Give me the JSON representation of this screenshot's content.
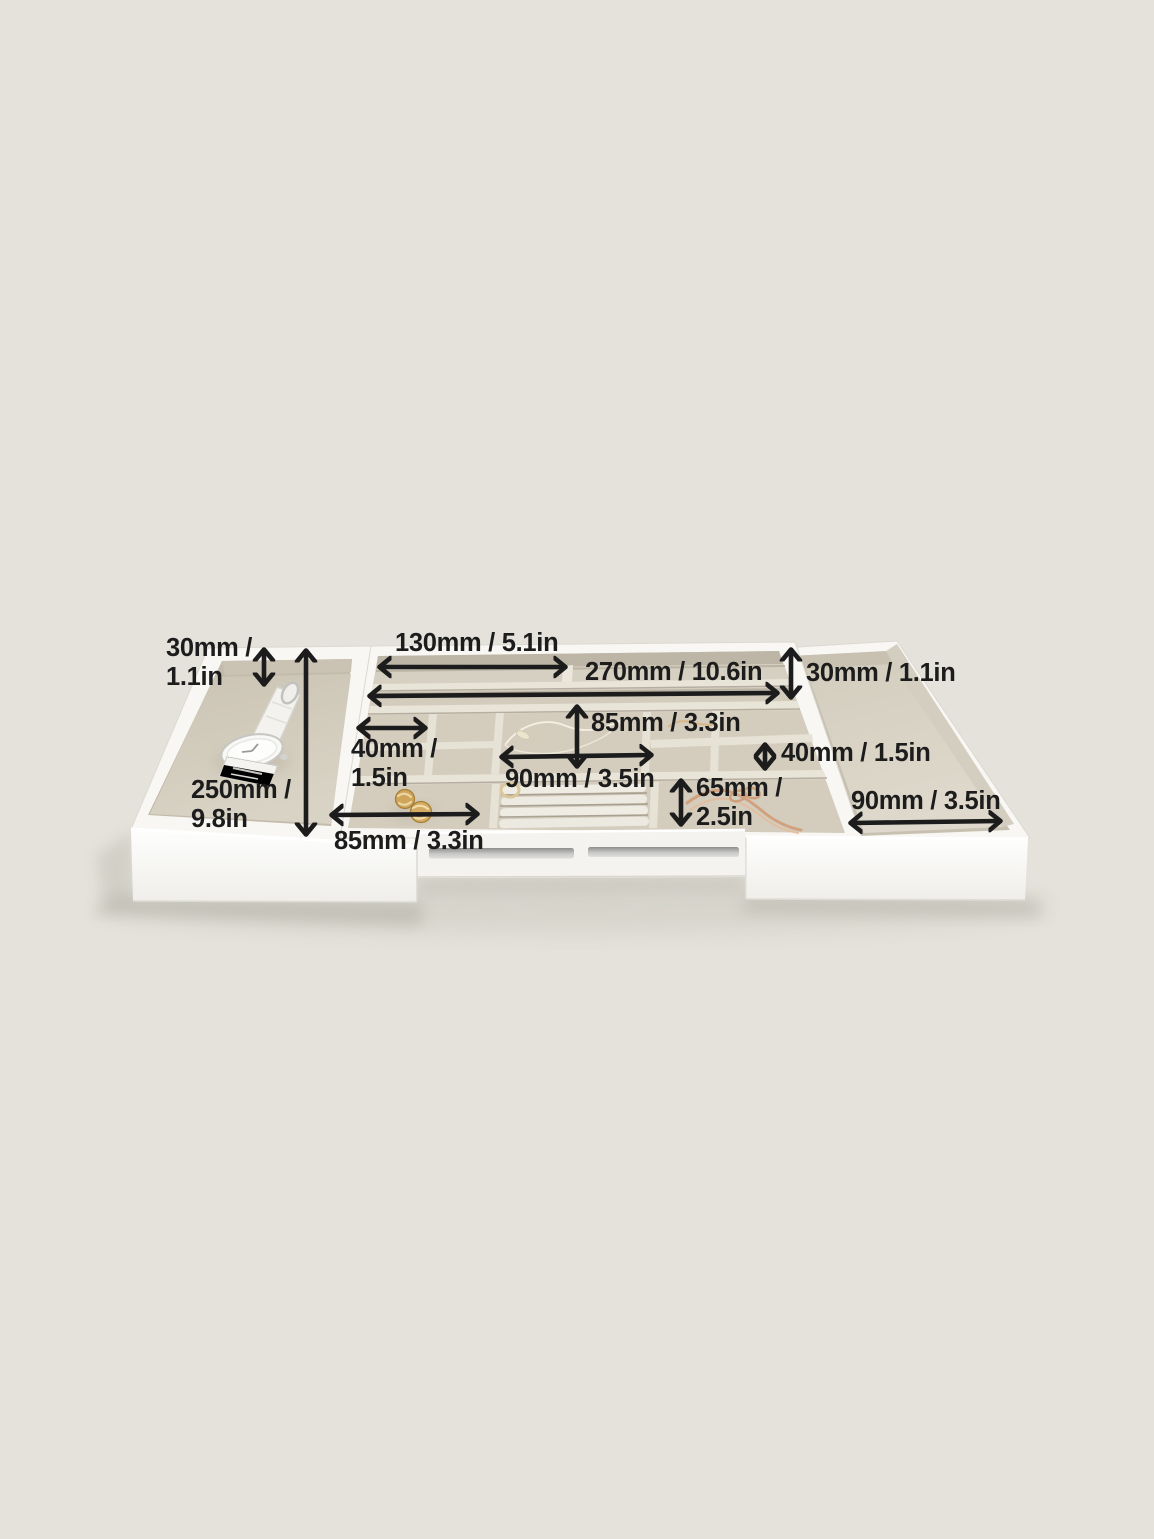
{
  "canvas": {
    "background": "#e4e2da"
  },
  "palette": {
    "tray_white": "#f8f7f3",
    "front_panel_white": "#fdfdfc",
    "velvet_floor": "#d5cec0",
    "velvet_wall": "#c3bbab",
    "divider_ridge": "#eae5da",
    "annotation": "#1c1c1c",
    "gold": "#cba158",
    "rose_gold": "#d2a27f",
    "rail_gray": "#9a9a9a"
  },
  "product": {
    "description": "Expandable white jewelry organizer tray with velvet compartments, watch, earrings and chain bracelet, annotated with dimensions"
  },
  "dimensions": [
    {
      "id": "left-tray-depth",
      "lines": [
        "30mm /",
        "1.1in"
      ]
    },
    {
      "id": "left-tray-length",
      "lines": [
        "250mm /",
        "9.8in"
      ]
    },
    {
      "id": "top-slot-left-width",
      "lines": [
        "130mm / 5.1in"
      ]
    },
    {
      "id": "top-slot-full-width",
      "lines": [
        "270mm / 10.6in"
      ]
    },
    {
      "id": "right-tray-depth",
      "lines": [
        "30mm / 1.1in"
      ]
    },
    {
      "id": "center-compartment-depth",
      "lines": [
        "85mm / 3.3in"
      ]
    },
    {
      "id": "small-compartment-width",
      "lines": [
        "40mm /",
        "1.5in"
      ]
    },
    {
      "id": "center-compartment-width",
      "lines": [
        "90mm / 3.5in"
      ]
    },
    {
      "id": "right-cell-depth",
      "lines": [
        "40mm / 1.5in"
      ]
    },
    {
      "id": "bottom-cell-depth",
      "lines": [
        "65mm /",
        "2.5in"
      ]
    },
    {
      "id": "bottom-compartment-width",
      "lines": [
        "85mm / 3.3in"
      ]
    },
    {
      "id": "right-tray-width",
      "lines": [
        "90mm / 3.5in"
      ]
    }
  ]
}
